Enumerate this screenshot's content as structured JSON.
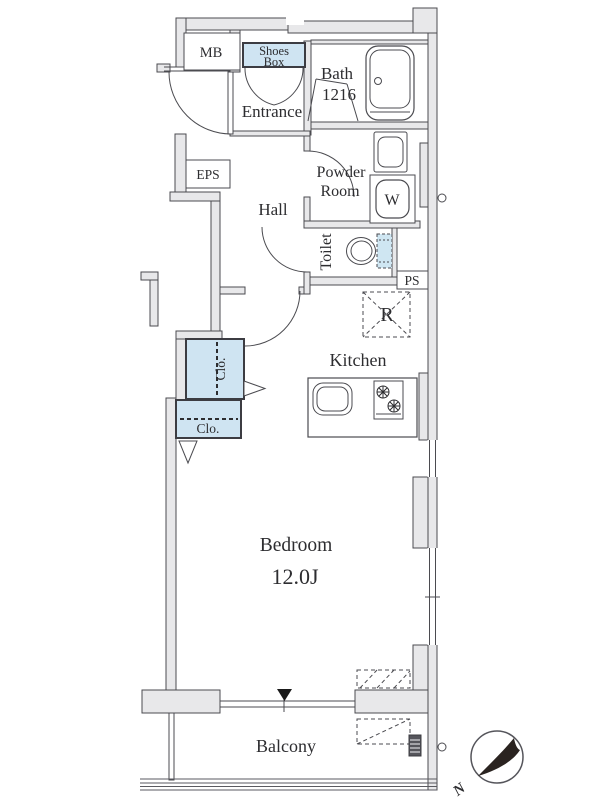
{
  "plan": {
    "labels": {
      "mb": "MB",
      "eps": "EPS",
      "ps": "PS",
      "shoes_box_line1": "Shoes",
      "shoes_box_line2": "Box",
      "bath": "Bath",
      "bath_size": "1216",
      "entrance": "Entrance",
      "powder_line1": "Powder",
      "powder_line2": "Room",
      "washer": "W",
      "hall": "Hall",
      "toilet": "Toilet",
      "fridge": "R",
      "kitchen": "Kitchen",
      "closet_upper": "Clo.",
      "closet_lower": "Clo.",
      "bedroom": "Bedroom",
      "bedroom_size": "12.0J",
      "balcony": "Balcony",
      "compass_north": "N"
    },
    "colors": {
      "wall_fill": "#e8e8ea",
      "outline": "#4b4b50",
      "closet_fill": "#cfe4f2",
      "tank_fill": "#cfe6f2",
      "needle": "#2a2320"
    }
  }
}
